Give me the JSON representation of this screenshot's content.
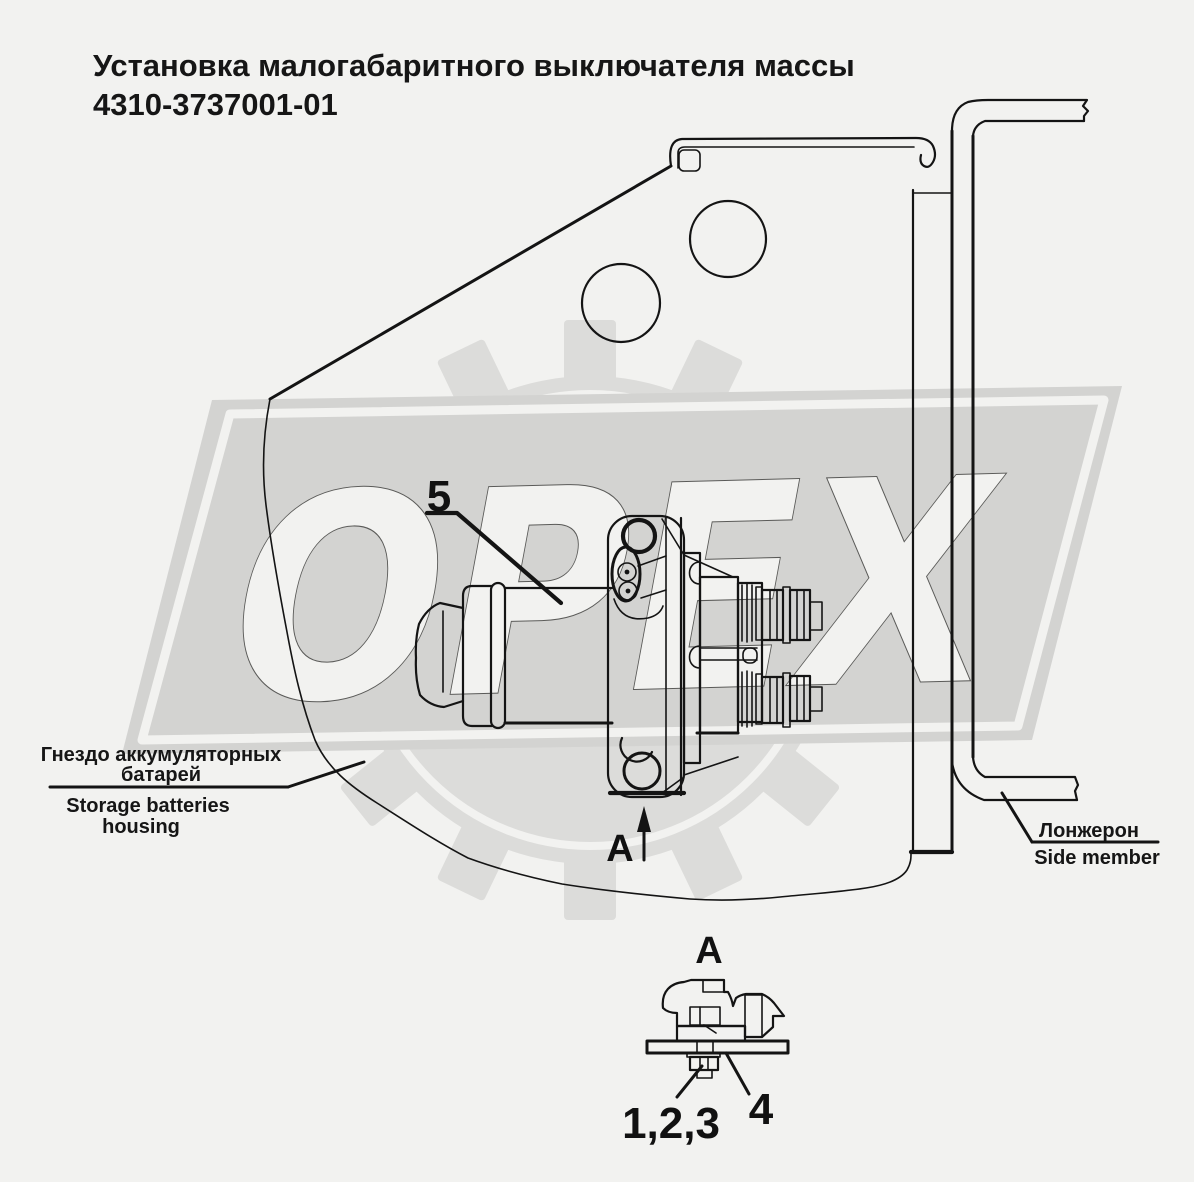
{
  "title": {
    "line1": "Установка малогабаритного выключателя массы",
    "line2": "4310-3737001-01"
  },
  "watermark": {
    "text": "ОРЕХ"
  },
  "labels": {
    "part5": "5",
    "view_arrow": "А",
    "detail_view": "А",
    "fasteners": "1,2,3",
    "washer": "4",
    "housing_ru1": "Гнездо аккумуляторных",
    "housing_ru2": "батарей",
    "housing_en1": "Storage batteries",
    "housing_en2": "housing",
    "side_member_ru": "Лонжерон",
    "side_member_en": "Side member"
  },
  "colors": {
    "background": "#f2f2f0",
    "line": "#141414",
    "watermark_band": "#d3d3d1",
    "watermark_gear": "#dcdcda",
    "watermark_letter_fill": "#f2f2f0",
    "watermark_letter_outline": "#5a5a58"
  }
}
